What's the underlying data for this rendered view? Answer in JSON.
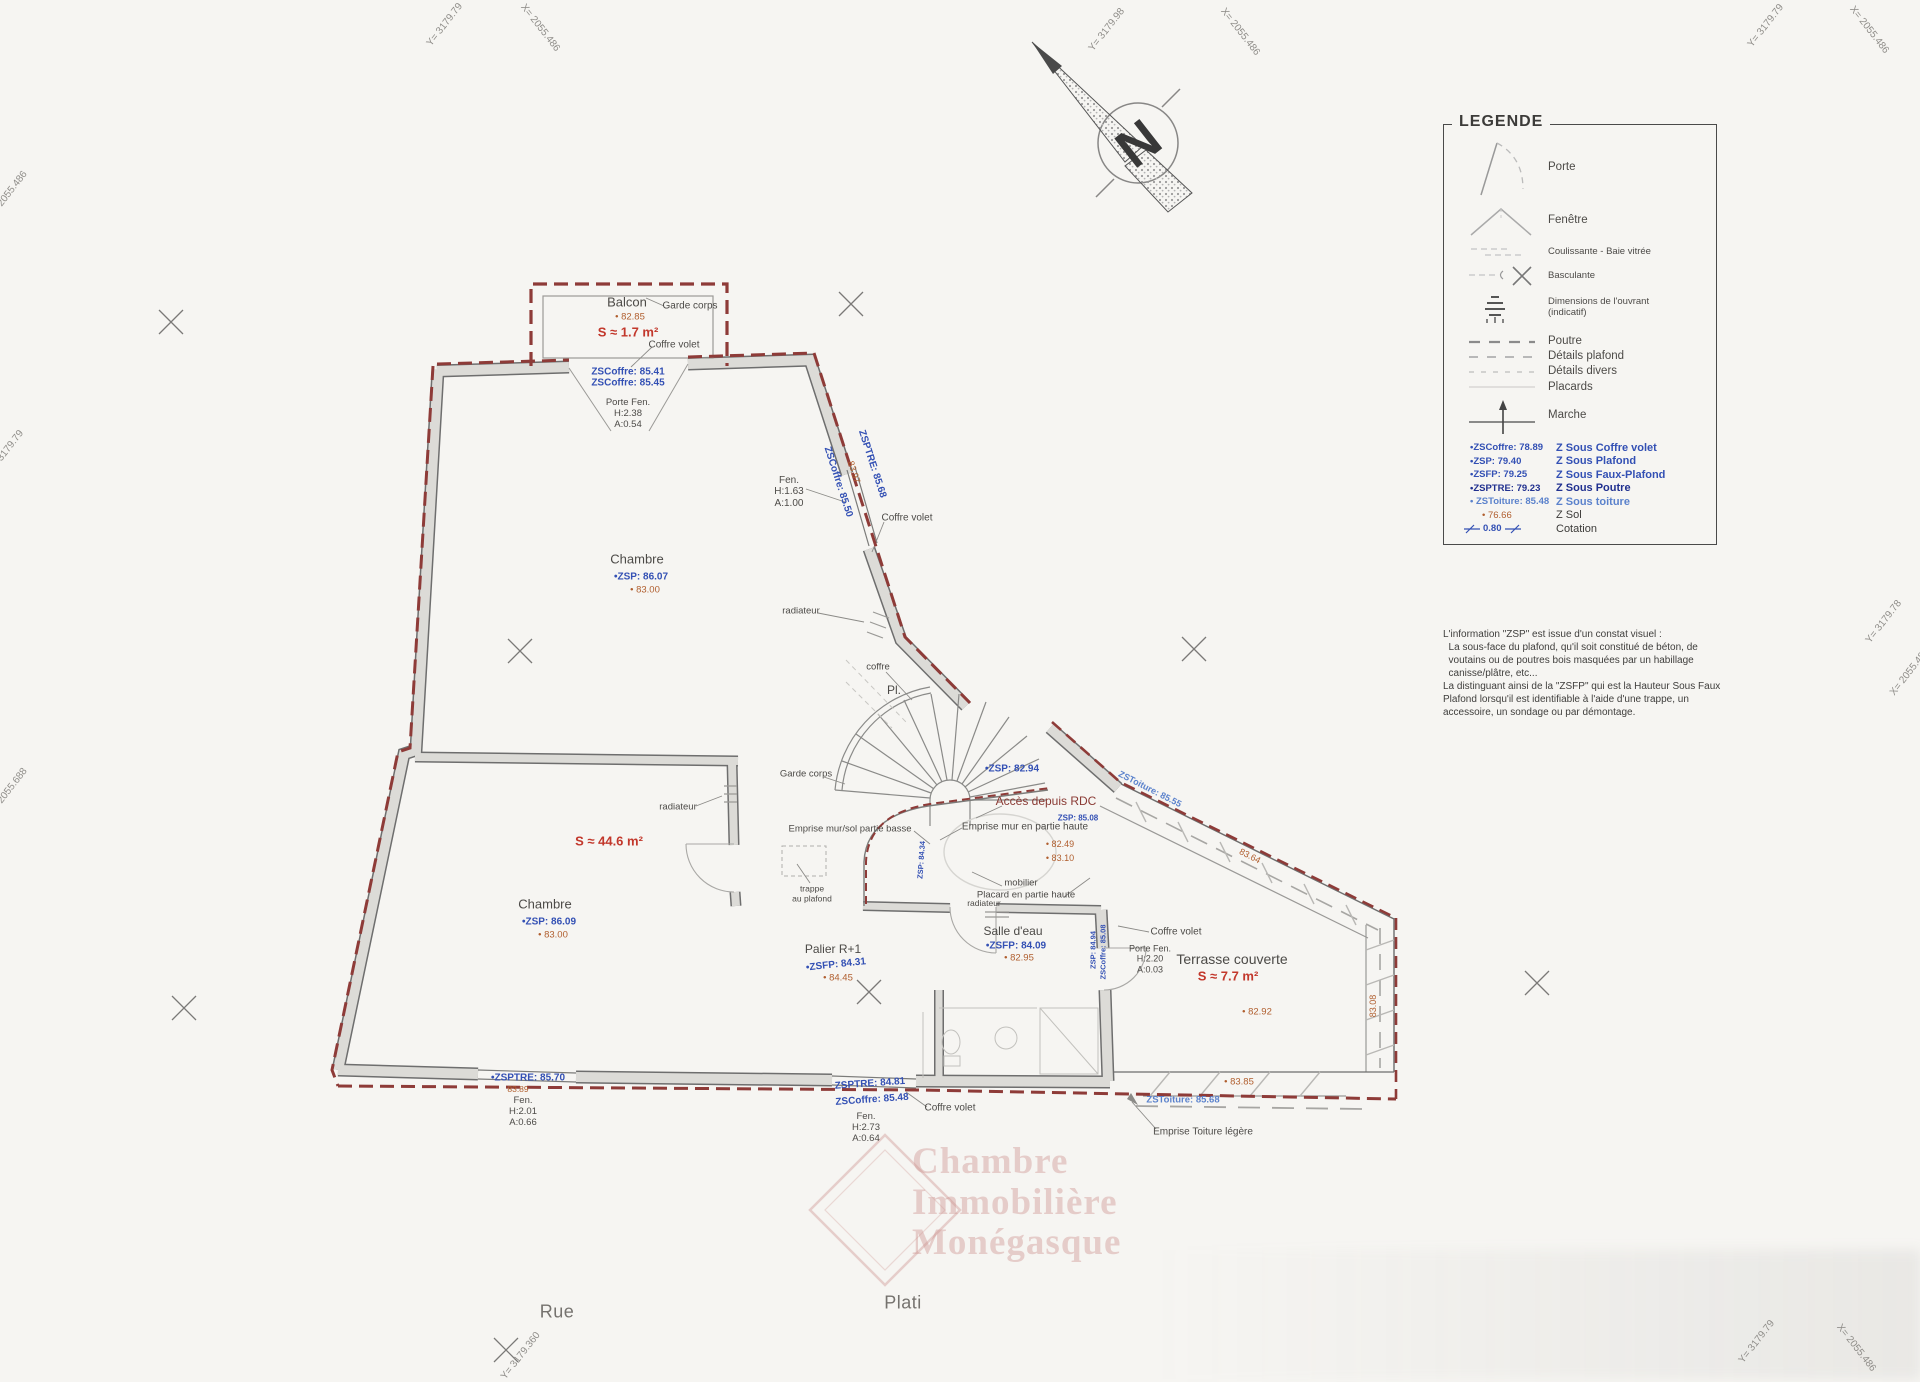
{
  "compass": {
    "letter": "N"
  },
  "legend": {
    "title": "LEGENDE",
    "items": [
      {
        "label": "Porte"
      },
      {
        "label": "Fenêtre"
      },
      {
        "label": "Coulissante - Baie vitrée"
      },
      {
        "label": "Basculante"
      },
      {
        "label": "Dimensions de l'ouvrant\n(indicatif)"
      },
      {
        "label": "Poutre"
      },
      {
        "label": "Détails plafond"
      },
      {
        "label": "Détails divers"
      },
      {
        "label": "Placards"
      },
      {
        "label": "Marche"
      }
    ],
    "values": [
      {
        "key": "•ZSCoffre: 78.89",
        "label": "Z Sous Coffre volet"
      },
      {
        "key": "•ZSP: 79.40",
        "label": "Z Sous Plafond"
      },
      {
        "key": "•ZSFP: 79.25",
        "label": "Z Sous Faux-Plafond"
      },
      {
        "key": "•ZSPTRE: 79.23",
        "label": "Z Sous Poutre"
      },
      {
        "key": "• ZSToiture: 85.48",
        "label": "Z Sous toiture"
      },
      {
        "key": "• 76.66",
        "label": "Z Sol"
      },
      {
        "key": "0.80",
        "label": "Cotation"
      }
    ],
    "note": "L'information \"ZSP\" est issue d'un constat visuel :\n  La sous-face du plafond, qu'il soit constitué de béton, de\n  voutains ou de poutres bois masquées par un habillage\n  canisse/plâtre, etc...\nLa distinguant ainsi de la \"ZSFP\" qui est la Hauteur Sous Faux\nPlafond lorsqu'il est identifiable à l'aide d'une trappe, un\naccessoire, un sondage ou par démontage."
  },
  "watermark": {
    "text": "Chambre\nImmobilière\nMonégasque"
  },
  "labels": [
    {
      "name": "balcon-title",
      "text": "Balcon",
      "x": 627,
      "y": 303,
      "fs": 13
    },
    {
      "name": "balcon-zsol",
      "text": "• 82.85",
      "x": 630,
      "y": 318,
      "cls": "orange",
      "fs": 9.5
    },
    {
      "name": "balcon-area",
      "text": "S ≈ 1.7 m²",
      "x": 628,
      "y": 333,
      "cls": "red",
      "fs": 13
    },
    {
      "name": "garde-corps-balcon",
      "text": "Garde corps",
      "x": 690,
      "y": 306,
      "fs": 10
    },
    {
      "name": "coffre-volet-balcon",
      "text": "Coffre volet",
      "x": 674,
      "y": 345,
      "fs": 10
    },
    {
      "name": "zscoffre-balcon",
      "text": "ZSCoffre: 85.41\nZSCoffre: 85.45",
      "x": 628,
      "y": 378,
      "cls": "blue",
      "fs": 10
    },
    {
      "name": "porte-fen-balcon",
      "text": "Porte Fen.\nH:2.38\nA:0.54",
      "x": 628,
      "y": 414,
      "fs": 9.5
    },
    {
      "name": "fen-upper",
      "text": "Fen.\nH:1.63\nA:1.00",
      "x": 789,
      "y": 492,
      "fs": 10
    },
    {
      "name": "zsptre-diag",
      "text": "ZSPTRE: 85.68",
      "x": 872,
      "y": 464,
      "cls": "blue",
      "fs": 10,
      "rot": 72
    },
    {
      "name": "zsol-diag",
      "text": "83.97",
      "x": 854,
      "y": 472,
      "cls": "orange",
      "fs": 9,
      "rot": 72
    },
    {
      "name": "zscoffre-diag",
      "text": "ZSCoffre: 85.50",
      "x": 838,
      "y": 482,
      "cls": "blue",
      "fs": 10,
      "rot": 72
    },
    {
      "name": "coffre-volet-upper",
      "text": "Coffre volet",
      "x": 907,
      "y": 518,
      "fs": 10
    },
    {
      "name": "chambre-upper-title",
      "text": "Chambre",
      "x": 637,
      "y": 560,
      "fs": 13
    },
    {
      "name": "chambre-upper-zsp",
      "text": "•ZSP: 86.07",
      "x": 641,
      "y": 577,
      "cls": "blue",
      "fs": 10
    },
    {
      "name": "chambre-upper-zsol",
      "text": "• 83.00",
      "x": 645,
      "y": 591,
      "cls": "orange",
      "fs": 9.5
    },
    {
      "name": "radiateur-upper",
      "text": "radiateur",
      "x": 801,
      "y": 612,
      "fs": 9.5
    },
    {
      "name": "coffre-mid",
      "text": "coffre",
      "x": 878,
      "y": 668,
      "fs": 9.5
    },
    {
      "name": "pl-label",
      "text": "Pl.",
      "x": 894,
      "y": 691,
      "fs": 12
    },
    {
      "name": "garde-corps-mid",
      "text": "Garde corps",
      "x": 806,
      "y": 775,
      "fs": 9.5
    },
    {
      "name": "zsp-stair",
      "text": "•ZSP: 82.94",
      "x": 1012,
      "y": 769,
      "cls": "blue",
      "fs": 10
    },
    {
      "name": "acces-depuis-rdc",
      "text": "Accès depuis RDC",
      "x": 1046,
      "y": 802,
      "cls": "dred",
      "fs": 12
    },
    {
      "name": "zsp-stair-2",
      "text": "ZSP: 85.08",
      "x": 1078,
      "y": 818,
      "cls": "blue",
      "fs": 8
    },
    {
      "name": "emprise-mur-haute",
      "text": "Emprise mur en partie haute",
      "x": 1025,
      "y": 827,
      "fs": 10
    },
    {
      "name": "stair-zsol-1",
      "text": "• 82.49",
      "x": 1060,
      "y": 844,
      "cls": "orange",
      "fs": 9
    },
    {
      "name": "stair-zsol-2",
      "text": "• 83.10",
      "x": 1060,
      "y": 858,
      "cls": "orange",
      "fs": 9
    },
    {
      "name": "emprise-mur-basse",
      "text": "Emprise mur/sol partie basse",
      "x": 850,
      "y": 830,
      "fs": 9.5
    },
    {
      "name": "radiateur-mid",
      "text": "radiateur",
      "x": 678,
      "y": 808,
      "fs": 9.5
    },
    {
      "name": "area-mid",
      "text": "S ≈ 44.6 m²",
      "x": 609,
      "y": 842,
      "cls": "red",
      "fs": 13
    },
    {
      "name": "trappe-plafond",
      "text": "trappe\nau plafond",
      "x": 812,
      "y": 894,
      "fs": 8.5
    },
    {
      "name": "mobilier",
      "text": "mobilier",
      "x": 1021,
      "y": 884,
      "fs": 9.5
    },
    {
      "name": "placard-haute",
      "text": "Placard en partie haute",
      "x": 1026,
      "y": 896,
      "fs": 9.5
    },
    {
      "name": "radiateur-low",
      "text": "radiateur",
      "x": 984,
      "y": 904,
      "fs": 8.5
    },
    {
      "name": "chambre-lower-title",
      "text": "Chambre",
      "x": 545,
      "y": 905,
      "fs": 13
    },
    {
      "name": "chambre-lower-zsp",
      "text": "•ZSP: 86.09",
      "x": 549,
      "y": 922,
      "cls": "blue",
      "fs": 10
    },
    {
      "name": "chambre-lower-zsol",
      "text": "• 83.00",
      "x": 553,
      "y": 936,
      "cls": "orange",
      "fs": 9.5
    },
    {
      "name": "palier-title",
      "text": "Palier R+1",
      "x": 833,
      "y": 950,
      "fs": 12
    },
    {
      "name": "palier-zsfp",
      "text": "•ZSFP: 84.31",
      "x": 836,
      "y": 965,
      "cls": "blue",
      "fs": 10,
      "rot": -6
    },
    {
      "name": "palier-zsol",
      "text": "• 84.45",
      "x": 838,
      "y": 979,
      "cls": "orange",
      "fs": 9.5
    },
    {
      "name": "salle-eau-title",
      "text": "Salle d'eau",
      "x": 1013,
      "y": 932,
      "fs": 12
    },
    {
      "name": "salle-eau-zsfp",
      "text": "•ZSFP: 84.09",
      "x": 1016,
      "y": 946,
      "cls": "blue",
      "fs": 10
    },
    {
      "name": "salle-eau-zsol",
      "text": "• 82.95",
      "x": 1019,
      "y": 959,
      "cls": "orange",
      "fs": 9.5
    },
    {
      "name": "wall-zsp-vert",
      "text": "ZSP: 84.94",
      "x": 1094,
      "y": 950,
      "cls": "blue",
      "fs": 7.5,
      "rot": -90
    },
    {
      "name": "wall-zscoffre-vert",
      "text": "ZSCoffre: 85.08",
      "x": 1104,
      "y": 952,
      "cls": "blue",
      "fs": 7.5,
      "rot": -90
    },
    {
      "name": "stair-wall-vert",
      "text": "ZSP: 84.34",
      "x": 922,
      "y": 860,
      "cls": "blue",
      "fs": 7.5,
      "rot": -86
    },
    {
      "name": "coffre-volet-terrasse",
      "text": "Coffre volet",
      "x": 1176,
      "y": 932,
      "fs": 10
    },
    {
      "name": "porte-fen-terrasse",
      "text": "Porte Fen.\nH:2.20\nA:0.03",
      "x": 1150,
      "y": 959,
      "fs": 9
    },
    {
      "name": "terrasse-title",
      "text": "Terrasse couverte",
      "x": 1232,
      "y": 960,
      "fs": 14
    },
    {
      "name": "terrasse-area",
      "text": "S ≈ 7.7 m²",
      "x": 1228,
      "y": 977,
      "cls": "red",
      "fs": 13
    },
    {
      "name": "terrasse-zsol",
      "text": "• 82.92",
      "x": 1257,
      "y": 1013,
      "cls": "orange",
      "fs": 9.5
    },
    {
      "name": "zstoiture-diag",
      "text": "ZSToiture: 85.55",
      "x": 1150,
      "y": 789,
      "cls": "lblue",
      "fs": 9,
      "rot": 27
    },
    {
      "name": "cote-diag",
      "text": "83.64",
      "x": 1250,
      "y": 856,
      "cls": "orange",
      "fs": 9,
      "rot": 27
    },
    {
      "name": "terrasse-right-cote",
      "text": "83.08",
      "x": 1373,
      "y": 1006,
      "cls": "orange",
      "fs": 9,
      "rot": -90
    },
    {
      "name": "zsptre-bottom-left",
      "text": "•ZSPTRE: 85.70",
      "x": 528,
      "y": 1078,
      "cls": "blue",
      "fs": 10
    },
    {
      "name": "zsol-bottom-left",
      "text": "83.89",
      "x": 518,
      "y": 1090,
      "cls": "orange",
      "fs": 8.5
    },
    {
      "name": "fen-bottom-left",
      "text": "Fen.\nH:2.01\nA:0.66",
      "x": 523,
      "y": 1112,
      "fs": 9.5
    },
    {
      "name": "zsptre-bottom-mid",
      "text": "ZSPTRE: 84.81",
      "x": 870,
      "y": 1084,
      "cls": "blue",
      "fs": 10,
      "rot": -4
    },
    {
      "name": "zscoffre-bottom-mid",
      "text": "ZSCoffre: 85.48",
      "x": 872,
      "y": 1100,
      "cls": "blue",
      "fs": 10,
      "rot": -4
    },
    {
      "name": "coffre-volet-bottom",
      "text": "Coffre volet",
      "x": 950,
      "y": 1108,
      "fs": 10
    },
    {
      "name": "fen-bottom-mid",
      "text": "Fen.\nH:2.73\nA:0.64",
      "x": 866,
      "y": 1128,
      "fs": 9.5
    },
    {
      "name": "terrasse-bottom-zsol",
      "text": "• 83.85",
      "x": 1239,
      "y": 1083,
      "cls": "orange",
      "fs": 9.5
    },
    {
      "name": "zstoiture-bottom-right",
      "text": "ZSToiture: 85.68",
      "x": 1183,
      "y": 1101,
      "cls": "lblue",
      "fs": 9.5
    },
    {
      "name": "emprise-toiture",
      "text": "Emprise Toiture légère",
      "x": 1203,
      "y": 1132,
      "fs": 10
    },
    {
      "name": "street-rue",
      "text": "Rue",
      "x": 557,
      "y": 1312,
      "cls": "street",
      "fs": 18
    },
    {
      "name": "street-plati",
      "text": "Plati",
      "x": 903,
      "y": 1303,
      "cls": "street",
      "fs": 18
    },
    {
      "name": "geo-top-left-y",
      "text": "Y= 3179.79",
      "x": 445,
      "y": 25,
      "cls": "geo",
      "fs": 10,
      "rot": -52
    },
    {
      "name": "geo-top-left-x",
      "text": "X= 2055.486",
      "x": 540,
      "y": 28,
      "cls": "geo",
      "fs": 10,
      "rot": 52
    },
    {
      "name": "geo-top-center-y",
      "text": "Y= 3179.98",
      "x": 1107,
      "y": 30,
      "cls": "geo",
      "fs": 10,
      "rot": -52
    },
    {
      "name": "geo-top-center-x",
      "text": "X= 2055.486",
      "x": 1240,
      "y": 32,
      "cls": "geo",
      "fs": 10,
      "rot": 52
    },
    {
      "name": "geo-top-right-y",
      "text": "Y= 3179.79",
      "x": 1766,
      "y": 26,
      "cls": "geo",
      "fs": 10,
      "rot": -52
    },
    {
      "name": "geo-top-right-x",
      "text": "X= 2055.486",
      "x": 1869,
      "y": 30,
      "cls": "geo",
      "fs": 10,
      "rot": 52
    },
    {
      "name": "geo-left-1",
      "text": "X= 2055.486",
      "x": 8,
      "y": 195,
      "cls": "geo",
      "fs": 10,
      "rot": -52
    },
    {
      "name": "geo-left-2",
      "text": "Y= 3179.79",
      "x": 6,
      "y": 452,
      "cls": "geo",
      "fs": 10,
      "rot": -52
    },
    {
      "name": "geo-left-3",
      "text": "X= 2055.688",
      "x": 8,
      "y": 792,
      "cls": "geo",
      "fs": 10,
      "rot": -52
    },
    {
      "name": "geo-right-1",
      "text": "Y= 3179.78",
      "x": 1884,
      "y": 622,
      "cls": "geo",
      "fs": 10,
      "rot": -52
    },
    {
      "name": "geo-right-2",
      "text": "X= 2055.486",
      "x": 1910,
      "y": 672,
      "cls": "geo",
      "fs": 10,
      "rot": -52
    },
    {
      "name": "geo-bottom-right-y",
      "text": "Y= 3179.79",
      "x": 1757,
      "y": 1342,
      "cls": "geo",
      "fs": 10,
      "rot": -52
    },
    {
      "name": "geo-bottom-right-x",
      "text": "X= 2055.486",
      "x": 1856,
      "y": 1348,
      "cls": "geo",
      "fs": 10,
      "rot": 52
    },
    {
      "name": "geo-bottom-left-y",
      "text": "Y= 3179.360",
      "x": 521,
      "y": 1356,
      "cls": "geo",
      "fs": 10,
      "rot": -52
    }
  ]
}
